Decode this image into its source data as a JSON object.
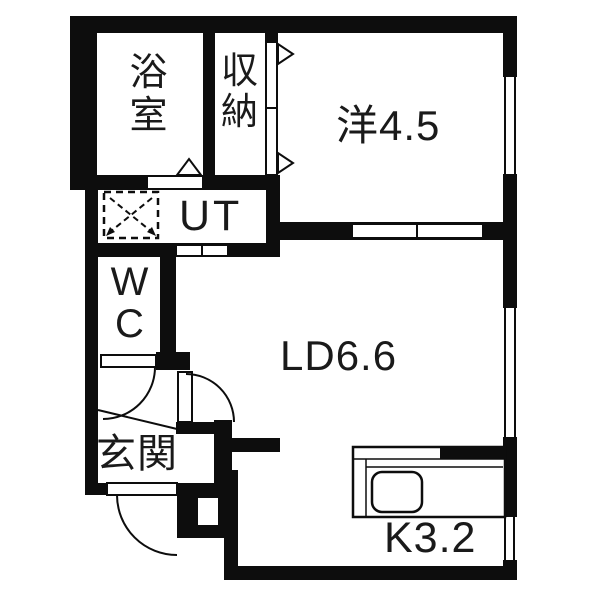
{
  "plan": {
    "type": "apartment-floor-plan",
    "labels": {
      "bathroom": "浴\n室",
      "storage": "収\n納",
      "western_room": "洋4.5",
      "utility": "UT",
      "toilet": "W\nC",
      "living_dining": "LD6.6",
      "entrance": "玄関",
      "kitchen": "K3.2"
    },
    "colors": {
      "wall": "#0d0d0d",
      "text": "#1a1a1a",
      "background": "#ffffff"
    },
    "symbols": [
      "washing-machine-space",
      "kitchen-sink",
      "sliding-door",
      "hinged-door",
      "folding-door",
      "window",
      "entrance-step-line"
    ]
  }
}
